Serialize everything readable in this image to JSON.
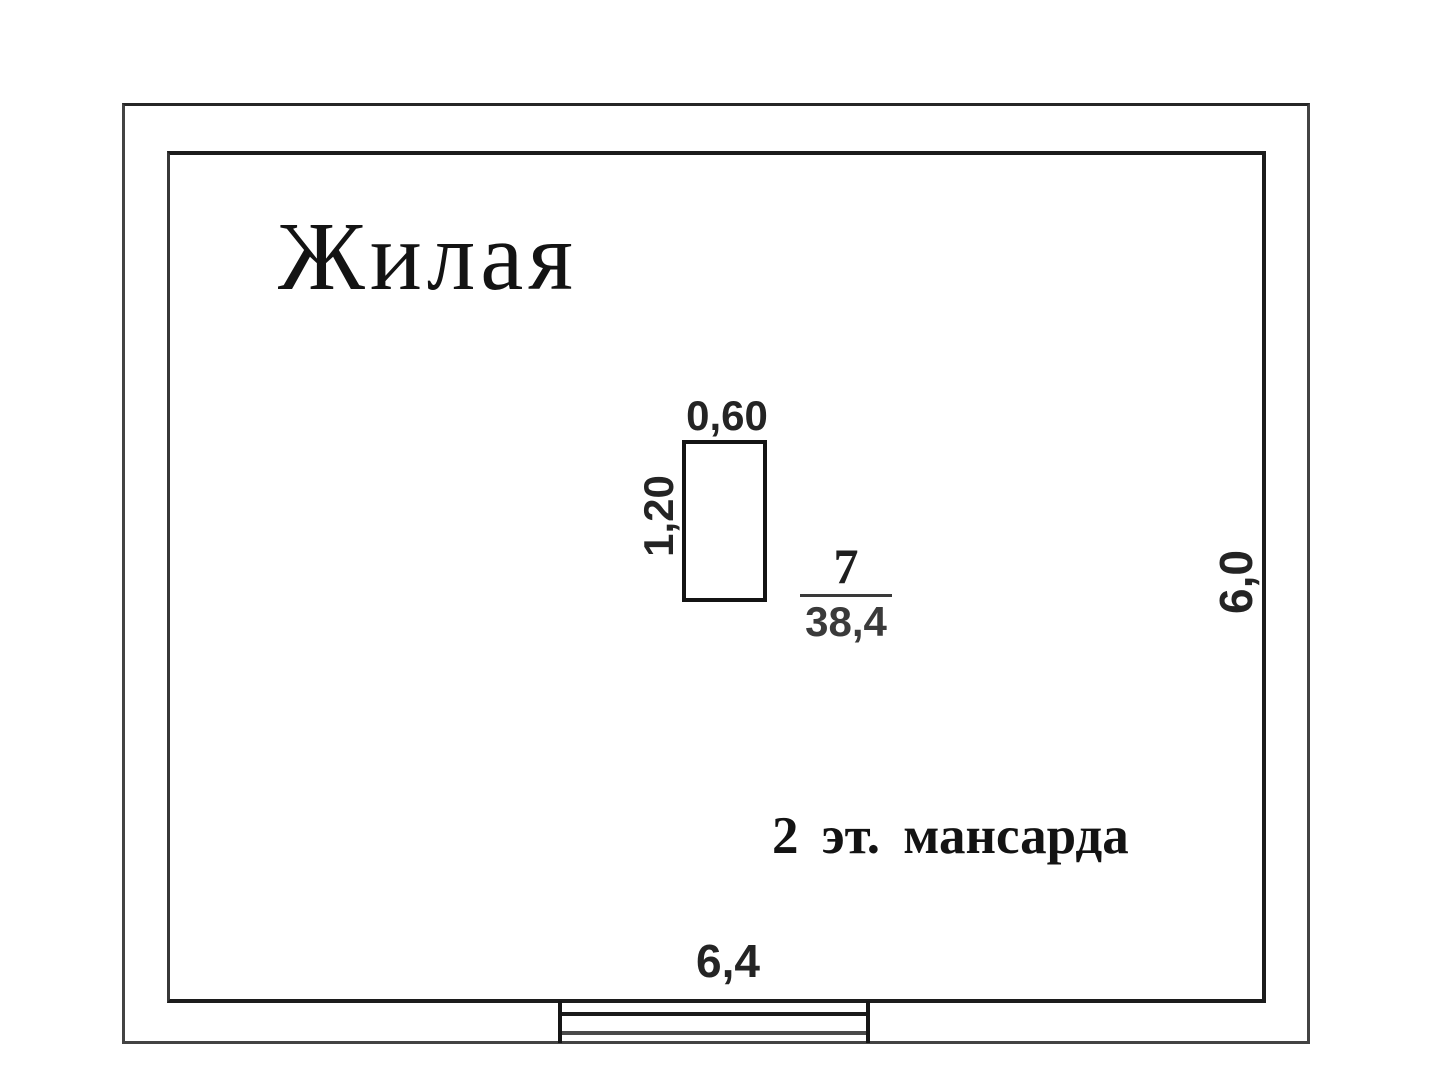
{
  "plan": {
    "room_label": "Жилая",
    "floor_note": "2 эт. мансарда",
    "room": {
      "number": "7",
      "area": "38,4"
    },
    "dimensions": {
      "stove_width": "0,60",
      "stove_height": "1,20",
      "bottom_width": "6,4",
      "right_height": "6,0"
    },
    "colors": {
      "background": "#ffffff",
      "inner_wall_line": "#1c1c1c",
      "outer_wall_line": "#434343",
      "window_glazing_line": "#4a4a4a",
      "label_text": "#131313",
      "dimension_text": "#242424",
      "area_text": "#3a3a3a"
    }
  }
}
